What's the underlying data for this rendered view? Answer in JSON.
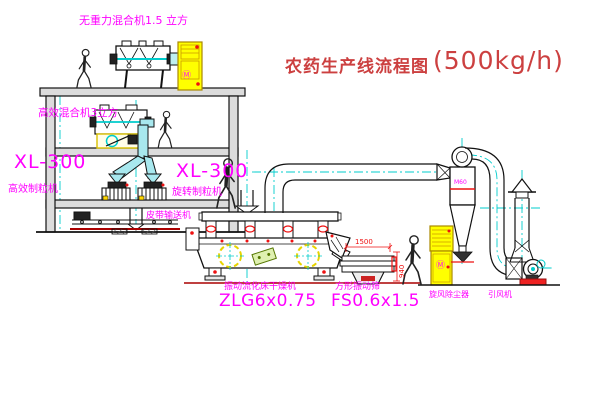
{
  "title": {
    "text": "农药生产线流程图",
    "capacity": "(500kg/h)"
  },
  "labels": {
    "gravity_mixer": "无重力混合机1.5 立方",
    "high_eff_mixer": "高效混合机3立方",
    "granulator_left_model": "XL-300",
    "granulator_left_name": "高效制粒机",
    "granulator_center_model": "XL-300",
    "granulator_center_name": "旋转制粒机",
    "belt_conveyor": "皮带输送机",
    "dryer_name": "振动流化床干燥机",
    "dryer_model": "ZLG6x0.75",
    "sieve_name": "方形振动筛",
    "sieve_model": "FS0.6x1.5",
    "cyclone_name": "旋风除尘器",
    "cyclone_tag": "M60",
    "fan_name": "引风机"
  },
  "dimensions": {
    "sieve_length": "1500",
    "sieve_height": "940"
  },
  "cabinets": {
    "marking": "Ⓜ"
  },
  "colors": {
    "magenta": "#ff00ff",
    "red": "#ee1111",
    "title_red": "#cc4040",
    "cyan_centerline": "#00cccc",
    "cabinet_yellow": "#ffff00",
    "line": "#111111",
    "belt_dark_red": "#aa0000"
  }
}
